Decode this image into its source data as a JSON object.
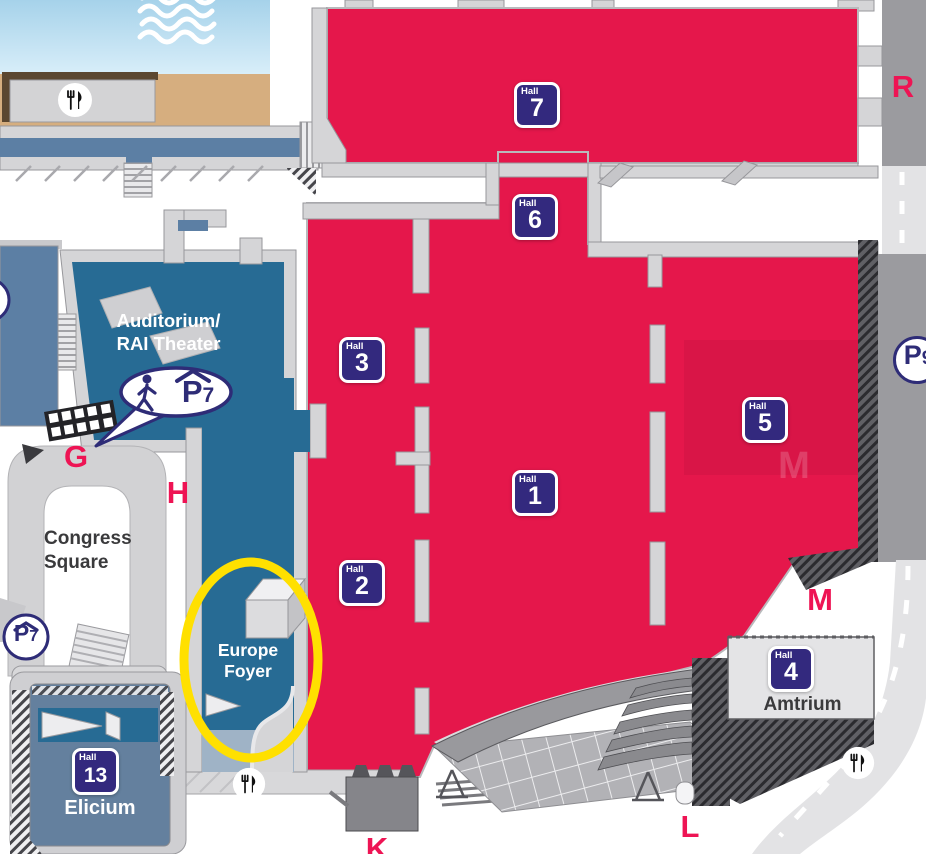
{
  "map_colors": {
    "hall_red": "#E5174B",
    "area_blue": "#276B94",
    "steel_blue": "#64809E",
    "badge_navy": "#33297E",
    "entrance_label_pink": "#EE1454",
    "highlight_yellow": "#FFE000",
    "water_blue": "#BCDFF1",
    "sand_beige": "#D6AE7F"
  },
  "hall_badge_prefix": "Hall",
  "halls": {
    "h1": "1",
    "h2": "2",
    "h3": "3",
    "h4": "4",
    "h5": "5",
    "h6": "6",
    "h7": "7",
    "h13": "13"
  },
  "areas": {
    "auditorium_line1": "Auditorium/",
    "auditorium_line2": "RAI Theater",
    "congress_line1": "Congress",
    "congress_line2": "Square",
    "foyer_line1": "Europe",
    "foyer_line2": "Foyer",
    "amtrium": "Amtrium",
    "elicium": "Elicium"
  },
  "entrances": {
    "r": "R",
    "g": "G",
    "h": "H",
    "m": "M",
    "m_watermark": "M",
    "l": "L",
    "k": "K"
  },
  "parking": {
    "p7_bubble_letter": "P",
    "p7_bubble_digit": "7",
    "p7_gate_letter": "P",
    "p7_gate_digit": "7",
    "p9_letter": "P",
    "p9_digit": "9"
  },
  "icons": {
    "restaurant": "fork-and-knife",
    "waves": "water-waves",
    "pedestrian": "walking-person"
  }
}
